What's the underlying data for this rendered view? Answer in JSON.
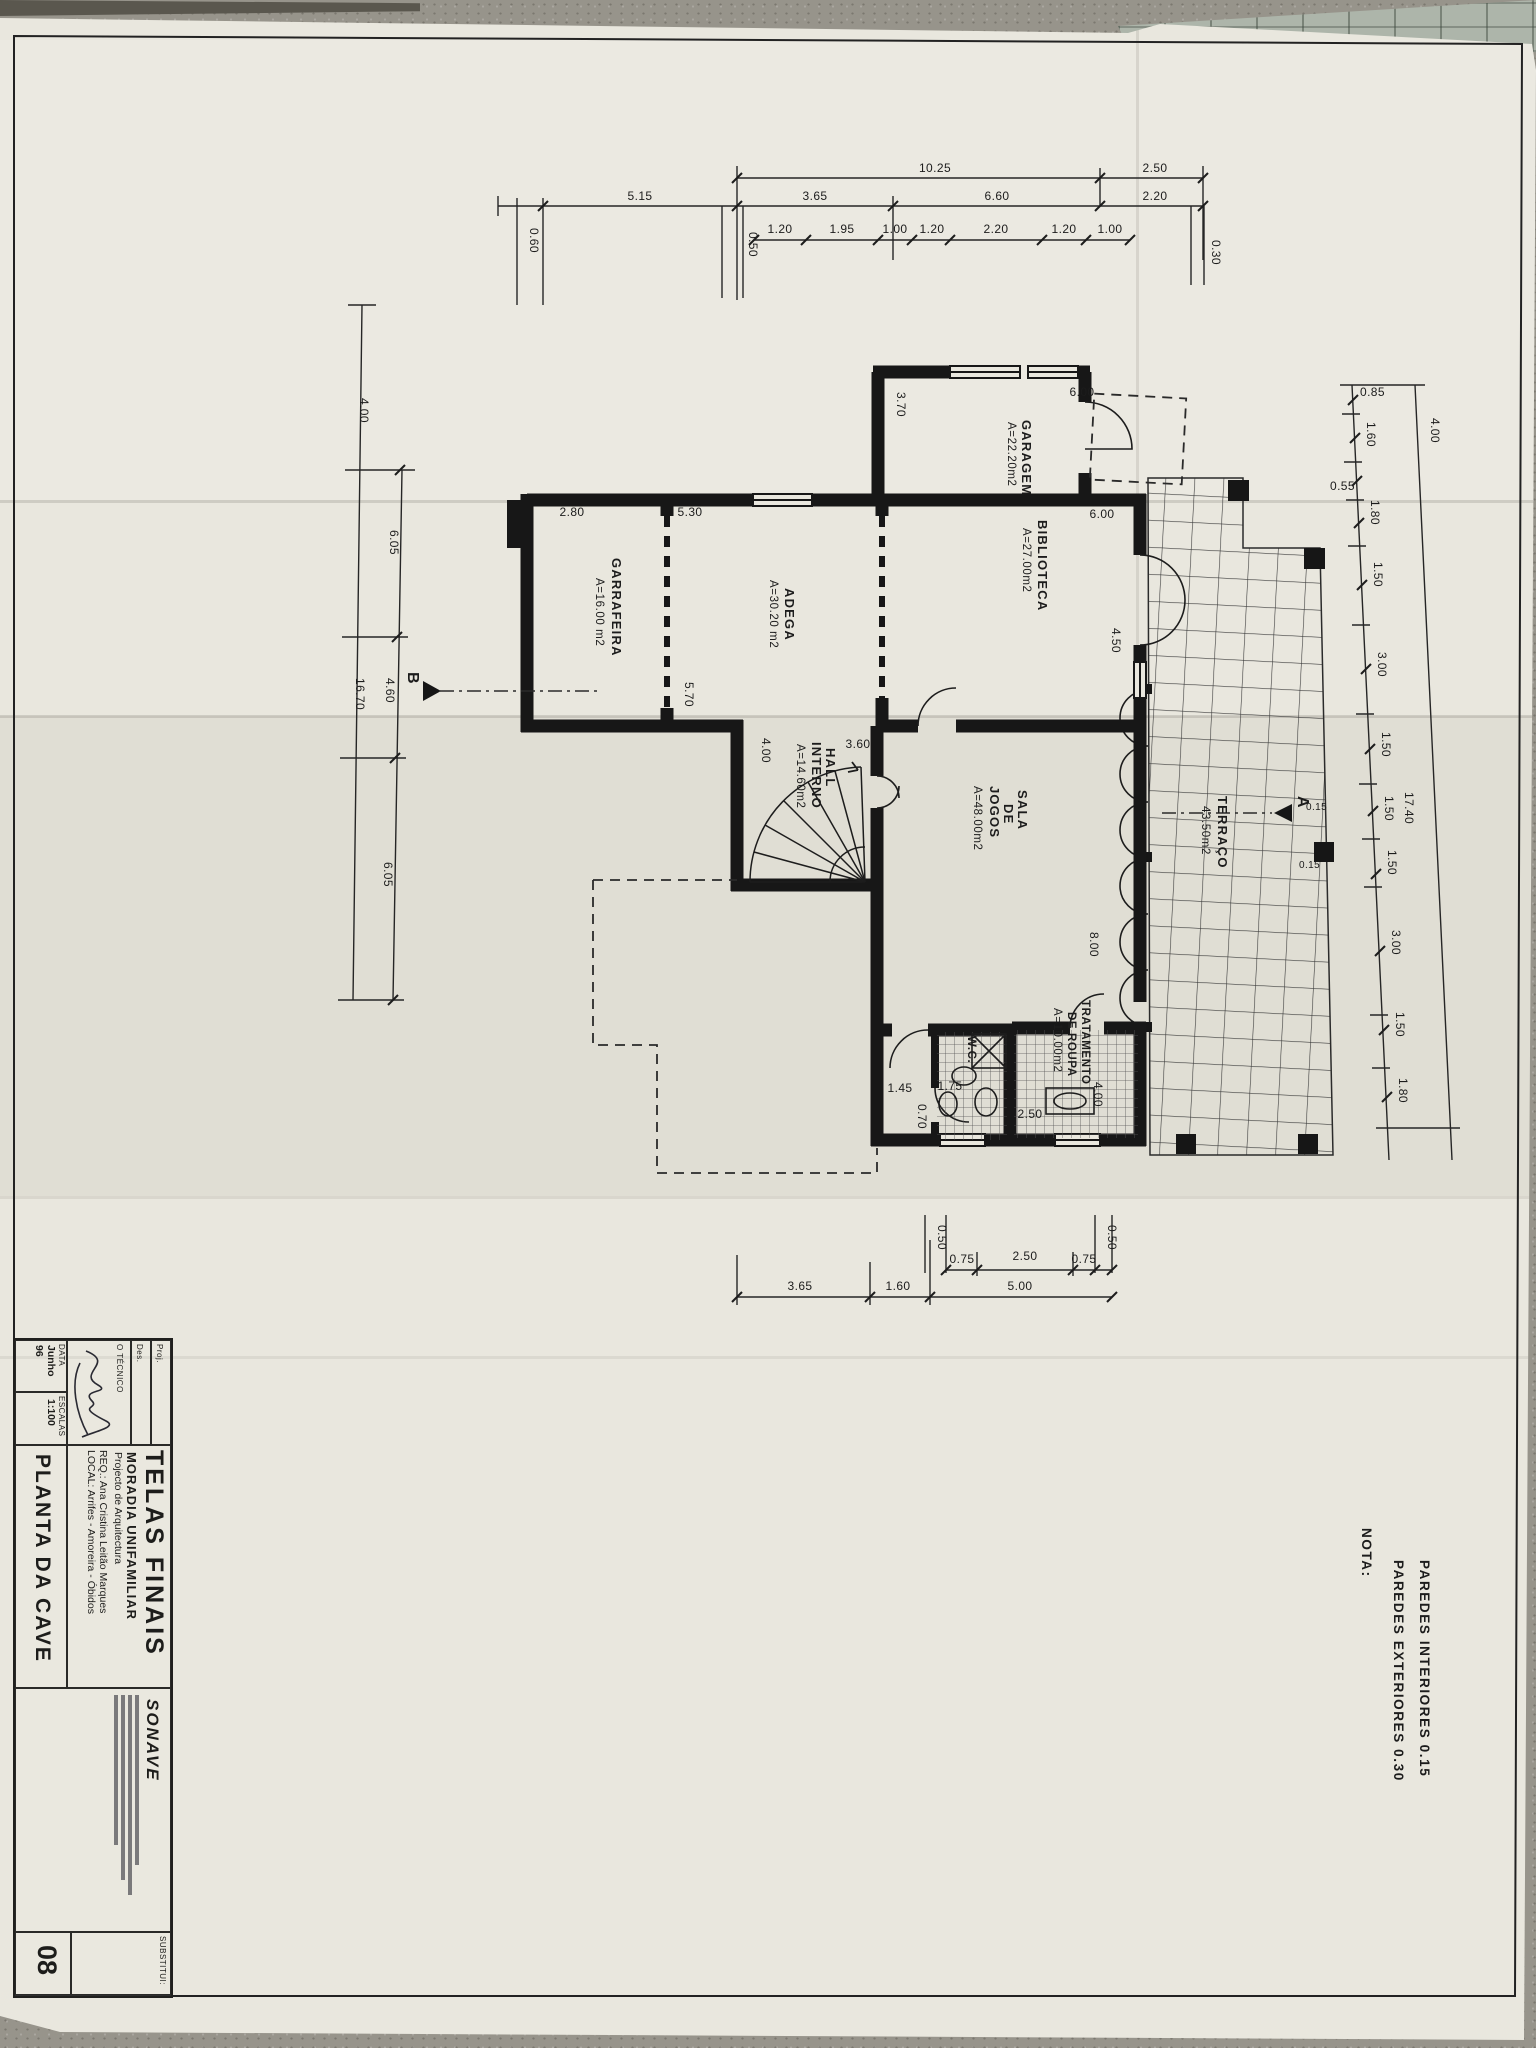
{
  "note": {
    "title": "NOTA:",
    "lines": [
      "PAREDES  EXTERIORES  0.30",
      "PAREDES  INTERIORES  0.15"
    ]
  },
  "rooms": {
    "garagem": {
      "name": "GARAGEM",
      "area": "A=22.20m2"
    },
    "biblioteca": {
      "name": "BIBLIOTECA",
      "area": "A=27.00m2"
    },
    "adega": {
      "name": "ADEGA",
      "area": "A=30.20 m2"
    },
    "garrafeira": {
      "name": "GARRAFEIRA",
      "area": "A=16.00 m2"
    },
    "hall": {
      "l1": "HALL",
      "l2": "INTERNO",
      "area": "A=14.60m2"
    },
    "sala": {
      "l1": "SALA",
      "l2": "DE",
      "l3": "JOGOS",
      "area": "A=48.00m2"
    },
    "wc": {
      "name": "W.C."
    },
    "tratamento": {
      "l1": "TRATAMENTO",
      "l2": "DE ROUPA",
      "area": "A=10.00m2"
    },
    "terraco": {
      "name": "TERRAÇO",
      "area": "43.50m2"
    }
  },
  "markers": {
    "a": "A",
    "b": "B"
  },
  "dims": {
    "topA": [
      "10.25",
      "2.50"
    ],
    "topB": [
      "5.15",
      "3.65",
      "6.60",
      "2.20"
    ],
    "topC": [
      "1.20",
      "1.95",
      "1.00",
      "1.20",
      "2.20",
      "1.20",
      "1.00"
    ],
    "topMisc": {
      "d060": "0.60",
      "d050": "0.50",
      "d030": "0.30"
    },
    "left": {
      "outer": [
        "4.00",
        "16.70"
      ],
      "inner": [
        "6.05",
        "4.60",
        "6.05"
      ]
    },
    "right": {
      "outer": [
        "4.00",
        "17.40"
      ],
      "inner": [
        "0.85",
        "1.60",
        "0.55",
        "1.80",
        "1.50",
        "3.00",
        "1.50",
        "1.50",
        "1.50",
        "3.00",
        "1.50",
        "1.80"
      ],
      "wall": [
        "0.15",
        "0.15"
      ]
    },
    "bottom": {
      "small": [
        "0.50",
        "0.75",
        "2.50",
        "0.75",
        "0.50"
      ],
      "main": [
        "3.65",
        "1.60",
        "5.00"
      ]
    },
    "plan": {
      "garage_w": "6.00",
      "garage_d": "3.70",
      "bib_w": "6.00",
      "bib_h": "4.50",
      "sala_h": "8.00",
      "garr_w": "2.80",
      "adega_w": "5.30",
      "adega_h": "5.70",
      "hall_w": "3.60",
      "hall_h": "4.00",
      "bath1": "1.45",
      "bath2": "0.70",
      "bath3": "1.75",
      "bath4": "2.50",
      "bath5": "4.00"
    }
  },
  "title_block": {
    "sheet_title": "TELAS FINAIS",
    "project": "MORADIA UNIFAMILIAR",
    "subtitle": "Projecto de Arquitectura",
    "req_line": "REQ.:  Ana Cristina Leitão Marques",
    "local_line": "LOCAL:  Arrifes - Amoreira - Óbidos",
    "drawing": "PLANTA  DA  CAVE",
    "proj_label": "Proj.",
    "des_label": "Des.",
    "tecnico_label": "O TÉCNICO",
    "data_label": "DATA",
    "data_value": "Junho 96",
    "escalas_label": "ESCALAS",
    "escalas_value": "1:100",
    "stamp_company": "SONAVE",
    "substitui_label": "SUBSTITUI:",
    "sheet_number": "08"
  }
}
